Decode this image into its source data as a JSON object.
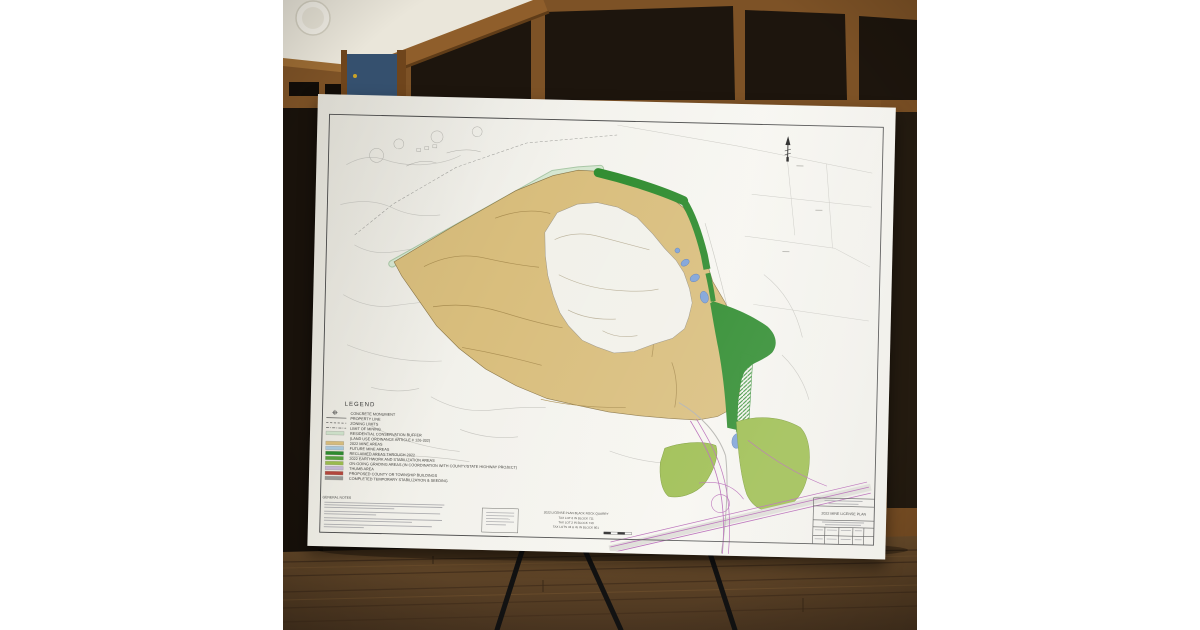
{
  "board": {
    "title_block": {
      "title": "2022 MINE LICENSE PLAN"
    },
    "site_block": {
      "lines": [
        "2022 LICENSE PLAN BLACK ROCK QUARRY",
        "TAX LOT 6 IN BLOCK 711",
        "TAX LOT 2 IN BLOCK 710",
        "TAX LOTS 43 & 45 IN BLOCK 801"
      ]
    },
    "notes": {
      "title": "GENERAL NOTES"
    },
    "legend": {
      "title": "LEGEND",
      "items": [
        {
          "symbol": "monument",
          "label": "CONCRETE MONUMENT"
        },
        {
          "symbol": "line-solid",
          "label": "PROPERTY LINE"
        },
        {
          "symbol": "line-dashed",
          "label": "ZONING LIMITS"
        },
        {
          "symbol": "line-dashdot",
          "label": "LIMIT OF MINING"
        },
        {
          "symbol": "swatch",
          "color": "#cfe2cb",
          "label": "RESIDENTIAL CONSERVATION BUFFER"
        },
        {
          "symbol": "none",
          "label": "(LAND USE ORDINANCE ARTICLE # 126-332)"
        },
        {
          "symbol": "swatch",
          "color": "#d9be7d",
          "label": "2022 MINE AREAS"
        },
        {
          "symbol": "swatch",
          "color": "#a9c9dd",
          "label": "FUTURE MINE AREAS"
        },
        {
          "symbol": "swatch",
          "color": "#2f8c2f",
          "label": "RECLAIMED AREAS THROUGH 2022"
        },
        {
          "symbol": "swatch",
          "color": "#58a33f",
          "label": "2022 EARTHWORK AND STABILIZATION AREAS"
        },
        {
          "symbol": "swatch",
          "color": "#9cbd4e",
          "label": "ON-GOING GRADING AREAS (IN COORDINATION WITH COUNTY/STATE HIGHWAY PROJECT)"
        },
        {
          "symbol": "swatch",
          "color": "#c6b8d6",
          "label": "THUMB AREA"
        },
        {
          "symbol": "swatch",
          "color": "#b5473c",
          "label": "PROPOSED COUNTY OR TOWNSHIP BUILDINGS"
        },
        {
          "symbol": "swatch",
          "color": "#9b9b97",
          "label": "COMPLETED TEMPORARY STABILIZATION & SEEDING"
        }
      ]
    },
    "colors": {
      "mine_area": "#d9be7d",
      "reclaimed": "#2f8c2f",
      "pond": "#7fa3d8",
      "grading": "#9cbd4e",
      "buffer": "#cfe2cb",
      "highway": "#b565b5"
    }
  }
}
